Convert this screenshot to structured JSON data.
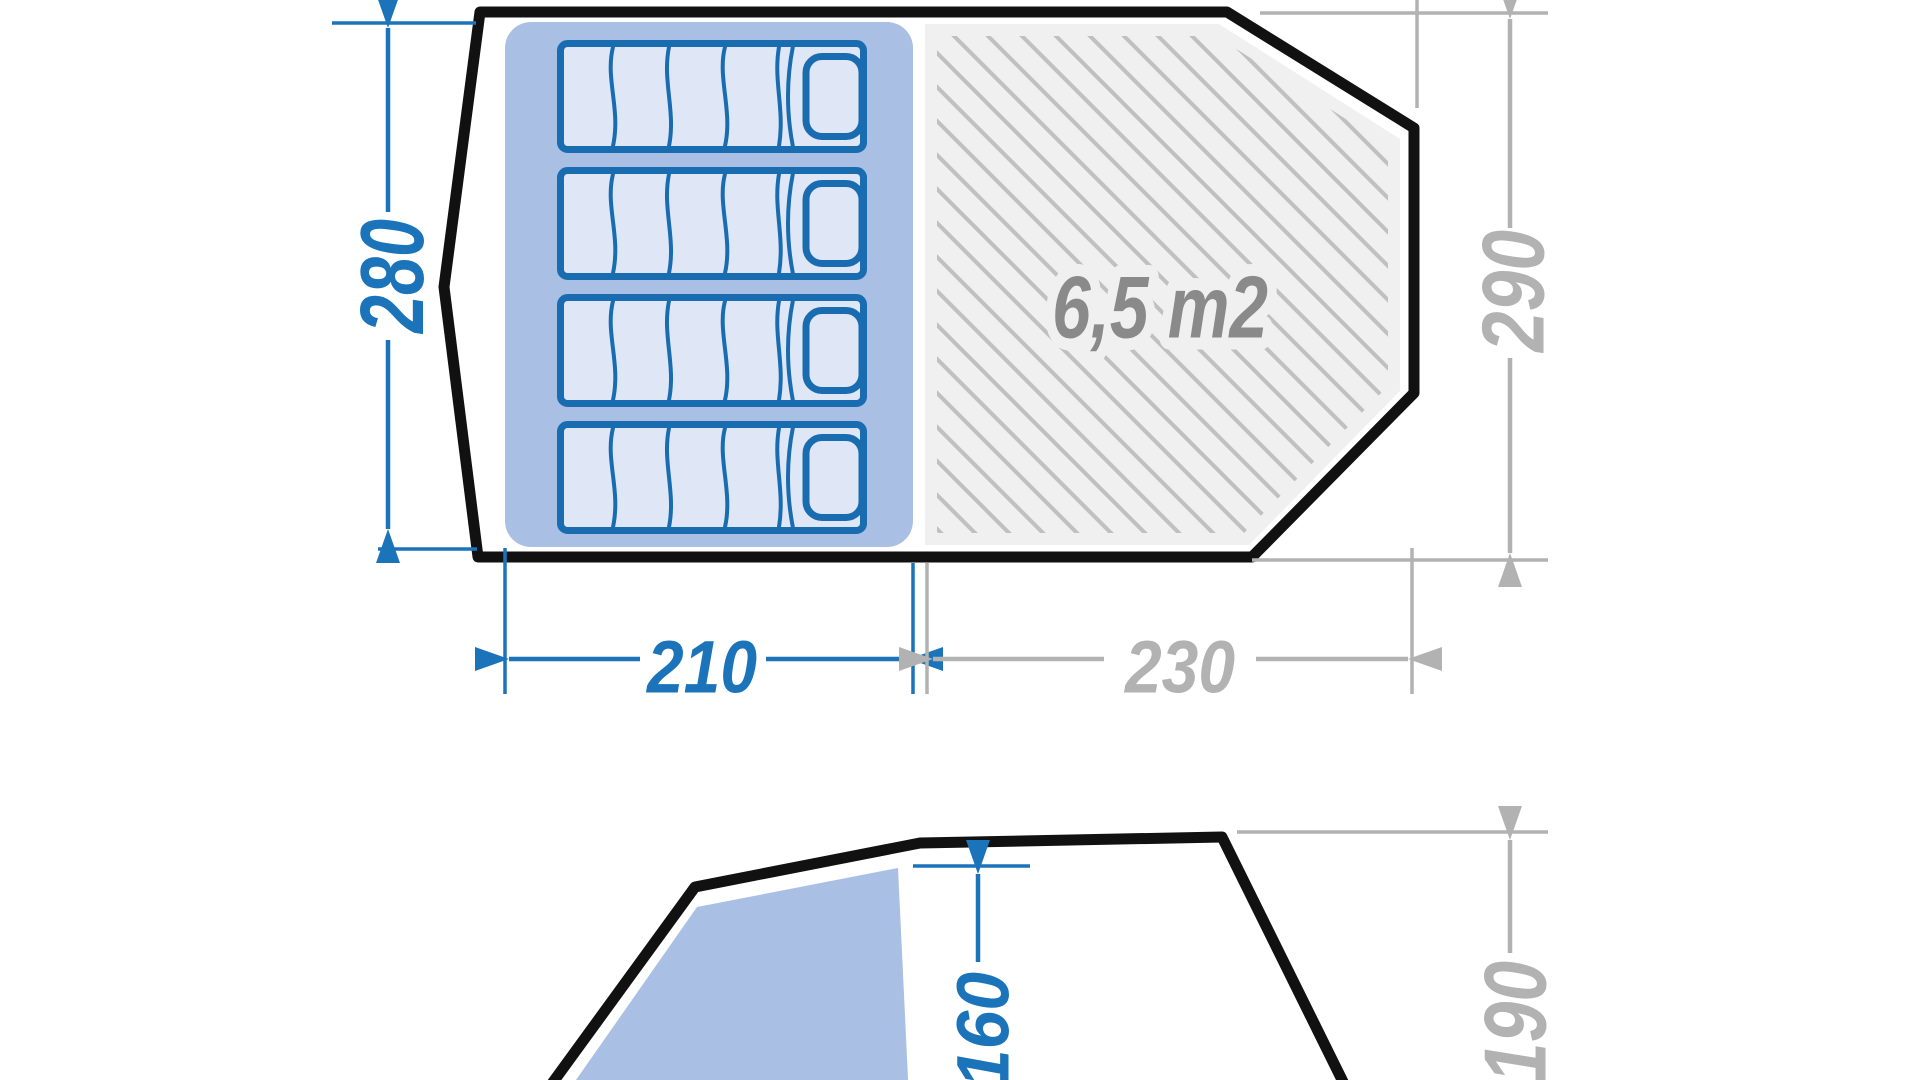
{
  "page": {
    "title": "Tent dimensions diagram"
  },
  "floor_plan": {
    "living_area_label": "6,5 m2",
    "dims": {
      "sleeping_depth": "280",
      "tent_depth": "290",
      "sleeping_width": "210",
      "living_width": "230"
    },
    "mattress_count": 4
  },
  "elevation": {
    "dims": {
      "door_height": "160",
      "tent_height": "190"
    }
  },
  "colors": {
    "dimension_blue": "#1b74ba",
    "dimension_gray": "#b2b2b2",
    "area_label_gray": "#8a8a8a",
    "sleeping_area_fill": "#a9bfe3",
    "door_panel_fill": "#a9bfe3",
    "mattress_fill": "#dfe7f6",
    "mattress_stroke": "#1a6cb0",
    "living_area_fill": "#f0f0f1",
    "hatch_line": "#c0c0c0",
    "tent_outline": "#111111"
  }
}
